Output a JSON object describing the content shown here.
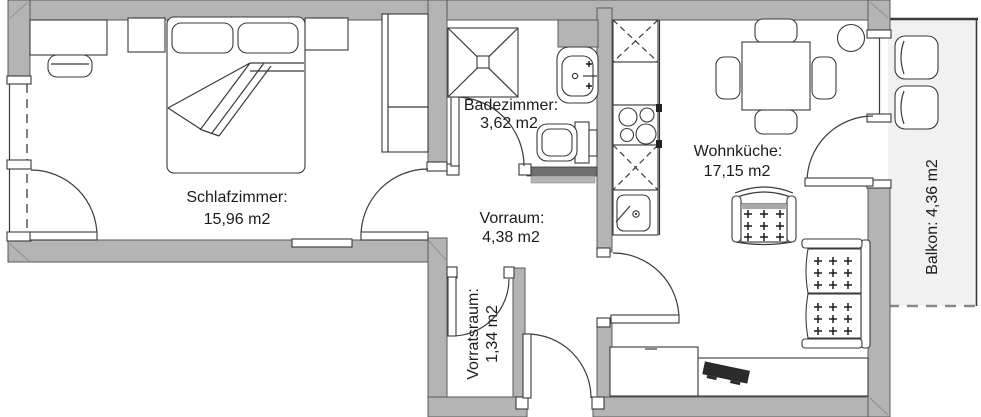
{
  "title": "Apartment floor plan",
  "rooms": {
    "schlafzimmer": {
      "name": "Schlafzimmer:",
      "area": "15,96 m2"
    },
    "badezimmer": {
      "name": "Badezimmer:",
      "area": "3,62 m2"
    },
    "vorraum": {
      "name": "Vorraum:",
      "area": "4,38 m2"
    },
    "vorratsraum": {
      "name": "Vorratsraum:",
      "area": "1,34 m2"
    },
    "wohnkueche": {
      "name": "Wohnküche:",
      "area": "17,15 m2"
    },
    "balkon": {
      "label": "Balkon: 4,36 m2"
    }
  },
  "colors": {
    "wall": "#b4b4b4",
    "line": "#3a3a3a",
    "balcony_fill": "#f1f1f1",
    "background": "#ffffff",
    "tv": "#2a2a2a"
  }
}
